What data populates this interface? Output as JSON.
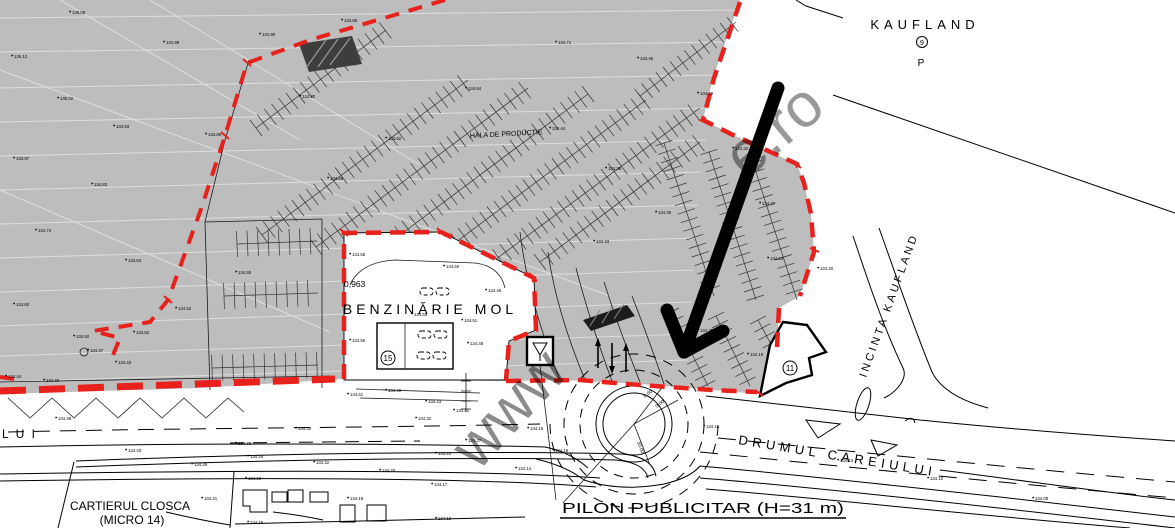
{
  "labels": {
    "kaufland": "KAUFLAND",
    "kaufland_num": "9",
    "kaufland_parking": "P",
    "hala": "HALA DE PRODUCTIE",
    "benzinarie": "BENZINĂRIE MOL",
    "area_value": "0,963",
    "incinta": "INCINTA KAUFLAND",
    "drumul": "DRUMUL CAREIULUI",
    "pilon": "PILON PUBLICITAR (H=31 m)",
    "cartierul_line1": "CARTIERUL CLOSCA",
    "cartierul_line2": "(MICRO 14)",
    "street_partial": "L U I",
    "building_gas_num": "15",
    "building_corner_num": "11",
    "dim_1": "6.00",
    "dim_2": "9.00",
    "dim_3": "30.00"
  },
  "watermark": {
    "part1": "www",
    "part2": "e.ro"
  },
  "colors": {
    "boundary_red": "#e8211d",
    "terrain_gray": "#bdbdbd",
    "arrow_black": "#000000",
    "watermark_gray": "#8c8c8c"
  },
  "spot_elevations": [
    {
      "x": 14,
      "y": 58,
      "v": "135.12"
    },
    {
      "x": 72,
      "y": 14,
      "v": "135.08"
    },
    {
      "x": 166,
      "y": 44,
      "v": "134.98"
    },
    {
      "x": 262,
      "y": 36,
      "v": "134.90"
    },
    {
      "x": 344,
      "y": 22,
      "v": "134.86"
    },
    {
      "x": 60,
      "y": 100,
      "v": "135.02"
    },
    {
      "x": 116,
      "y": 128,
      "v": "134.93"
    },
    {
      "x": 208,
      "y": 136,
      "v": "134.86"
    },
    {
      "x": 302,
      "y": 98,
      "v": "134.80"
    },
    {
      "x": 16,
      "y": 160,
      "v": "134.97"
    },
    {
      "x": 94,
      "y": 186,
      "v": "134.83"
    },
    {
      "x": 38,
      "y": 232,
      "v": "134.74"
    },
    {
      "x": 128,
      "y": 262,
      "v": "134.63"
    },
    {
      "x": 16,
      "y": 306,
      "v": "134.60"
    },
    {
      "x": 76,
      "y": 338,
      "v": "134.50"
    },
    {
      "x": 118,
      "y": 364,
      "v": "134.43"
    },
    {
      "x": 178,
      "y": 310,
      "v": "134.52"
    },
    {
      "x": 238,
      "y": 274,
      "v": "134.55"
    },
    {
      "x": 330,
      "y": 180,
      "v": "134.68"
    },
    {
      "x": 388,
      "y": 140,
      "v": "134.62"
    },
    {
      "x": 468,
      "y": 90,
      "v": "134.64"
    },
    {
      "x": 558,
      "y": 44,
      "v": "134.71"
    },
    {
      "x": 552,
      "y": 130,
      "v": "134.44"
    },
    {
      "x": 608,
      "y": 170,
      "v": "134.38"
    },
    {
      "x": 658,
      "y": 214,
      "v": "134.30"
    },
    {
      "x": 596,
      "y": 243,
      "v": "134.33"
    },
    {
      "x": 640,
      "y": 60,
      "v": "134.46"
    },
    {
      "x": 700,
      "y": 95,
      "v": "134.40"
    },
    {
      "x": 735,
      "y": 150,
      "v": "134.32"
    },
    {
      "x": 762,
      "y": 205,
      "v": "134.27"
    },
    {
      "x": 770,
      "y": 260,
      "v": "134.23"
    },
    {
      "x": 820,
      "y": 270,
      "v": "134.20"
    },
    {
      "x": 700,
      "y": 332,
      "v": "134.22"
    },
    {
      "x": 750,
      "y": 356,
      "v": "134.19"
    },
    {
      "x": 352,
      "y": 256,
      "v": "134.58"
    },
    {
      "x": 446,
      "y": 268,
      "v": "134.50"
    },
    {
      "x": 488,
      "y": 292,
      "v": "134.46"
    },
    {
      "x": 414,
      "y": 316,
      "v": "134.55"
    },
    {
      "x": 464,
      "y": 322,
      "v": "134.51"
    },
    {
      "x": 470,
      "y": 345,
      "v": "134.48"
    },
    {
      "x": 352,
      "y": 342,
      "v": "134.56"
    },
    {
      "x": 428,
      "y": 403,
      "v": "134.43"
    },
    {
      "x": 456,
      "y": 412,
      "v": "134.41"
    },
    {
      "x": 388,
      "y": 392,
      "v": "134.49"
    },
    {
      "x": 350,
      "y": 396,
      "v": "134.51"
    },
    {
      "x": 8,
      "y": 378,
      "v": "134.44"
    },
    {
      "x": 46,
      "y": 382,
      "v": "134.40"
    },
    {
      "x": 90,
      "y": 352,
      "v": "134.47"
    },
    {
      "x": 136,
      "y": 334,
      "v": "134.52"
    },
    {
      "x": 58,
      "y": 420,
      "v": "134.38"
    },
    {
      "x": 128,
      "y": 452,
      "v": "134.33"
    },
    {
      "x": 194,
      "y": 466,
      "v": "134.29"
    },
    {
      "x": 250,
      "y": 458,
      "v": "134.26"
    },
    {
      "x": 316,
      "y": 464,
      "v": "134.22"
    },
    {
      "x": 382,
      "y": 472,
      "v": "134.20"
    },
    {
      "x": 438,
      "y": 455,
      "v": "134.24"
    },
    {
      "x": 468,
      "y": 442,
      "v": "134.27"
    },
    {
      "x": 418,
      "y": 420,
      "v": "134.32"
    },
    {
      "x": 298,
      "y": 430,
      "v": "134.30"
    },
    {
      "x": 238,
      "y": 445,
      "v": "134.35"
    },
    {
      "x": 434,
      "y": 486,
      "v": "134.17"
    },
    {
      "x": 518,
      "y": 470,
      "v": "134.14"
    },
    {
      "x": 248,
      "y": 480,
      "v": "134.23"
    },
    {
      "x": 204,
      "y": 500,
      "v": "134.21"
    },
    {
      "x": 438,
      "y": 520,
      "v": "134.12"
    },
    {
      "x": 530,
      "y": 430,
      "v": "134.18"
    },
    {
      "x": 706,
      "y": 428,
      "v": "134.16"
    },
    {
      "x": 840,
      "y": 462,
      "v": "134.13"
    },
    {
      "x": 930,
      "y": 480,
      "v": "134.10"
    },
    {
      "x": 1035,
      "y": 500,
      "v": "134.08"
    },
    {
      "x": 250,
      "y": 524,
      "v": "134.15"
    },
    {
      "x": 350,
      "y": 500,
      "v": "134.18"
    },
    {
      "x": 555,
      "y": 452,
      "v": "134.16"
    }
  ]
}
